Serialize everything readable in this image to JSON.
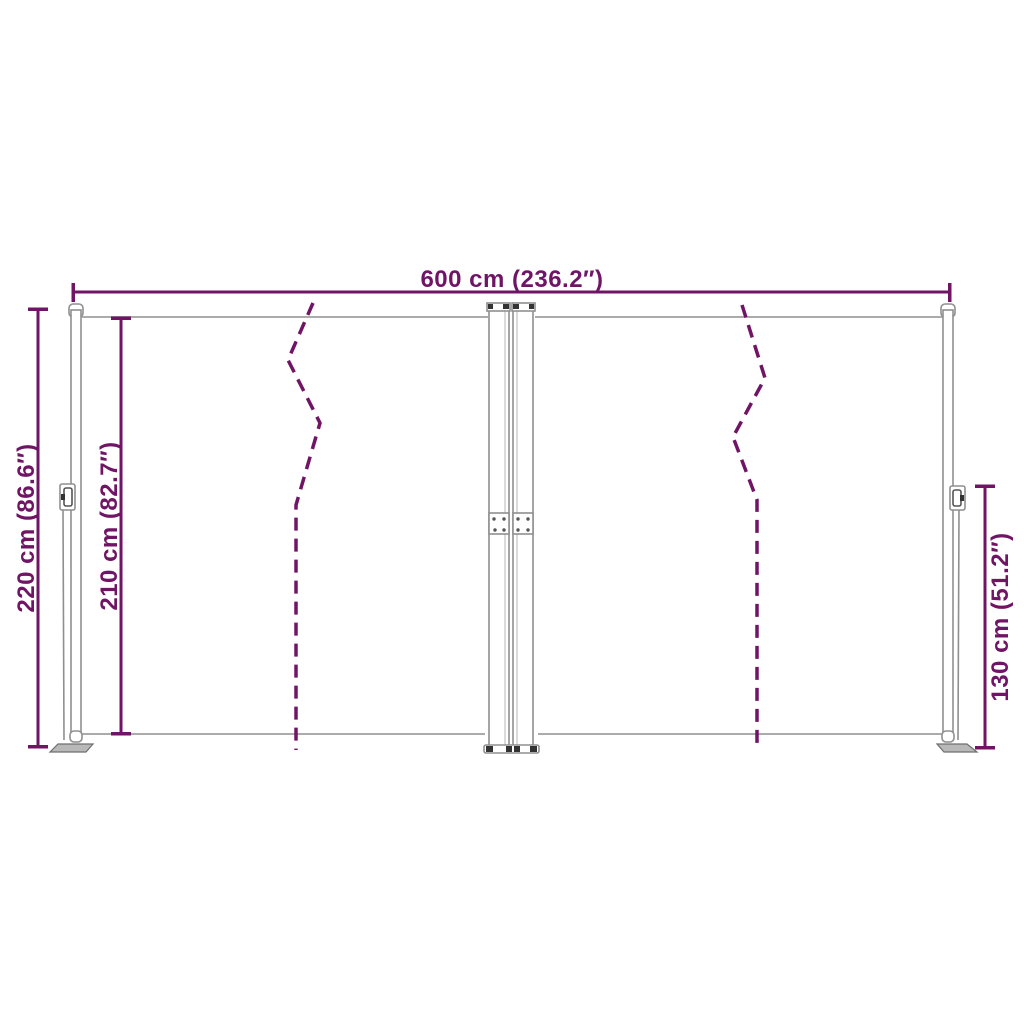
{
  "diagram": {
    "title": "awning-dimension-diagram",
    "labels": {
      "width_top": "600 cm (236.2″)",
      "height_outer_left": "220 cm (86.6″)",
      "height_inner_left": "210 cm (82.7″)",
      "height_right": "130 cm (51.2″)"
    },
    "measurements": {
      "width_top": {
        "cm": 600,
        "inches": 236.2
      },
      "height_outer_left": {
        "cm": 220,
        "inches": 86.6
      },
      "height_inner_left": {
        "cm": 210,
        "inches": 82.7
      },
      "height_right": {
        "cm": 130,
        "inches": 51.2
      }
    },
    "colors": {
      "dimension_accent": "#701566",
      "fold_line": "#701566",
      "structure_light_gray": "#ababab",
      "structure_mid_gray": "#8f8f8f",
      "detail_dark": "#333333",
      "background": "#ffffff"
    }
  }
}
